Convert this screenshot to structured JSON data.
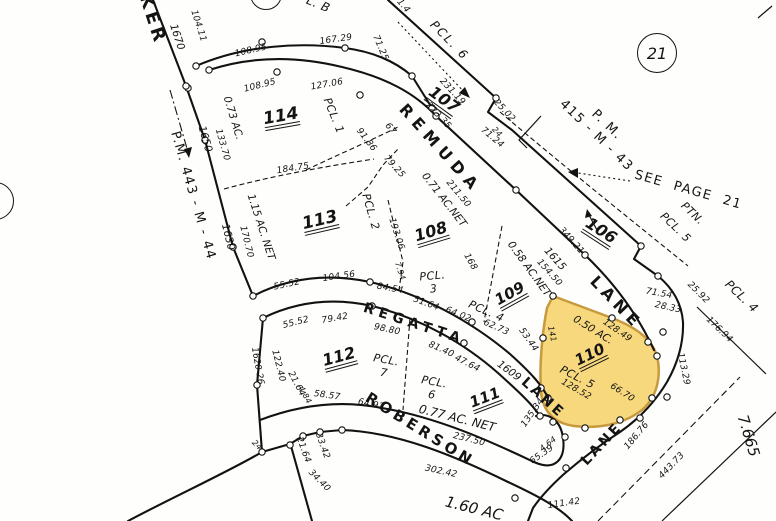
{
  "page_ref": {
    "circled": "21"
  },
  "highlight": {
    "parcel": "110",
    "fill": "#F7D87D",
    "edge": "#C79A3E"
  },
  "labels": [
    {
      "n": "street-walker-partial",
      "t": "KER",
      "x": 152,
      "y": 20,
      "r": 72,
      "c": "street",
      "s": 18,
      "sp": 4
    },
    {
      "n": "street-remuda",
      "t": "REMUDA",
      "x": 440,
      "y": 149,
      "r": 48,
      "c": "street",
      "s": 16,
      "sp": 6
    },
    {
      "n": "street-remuda-lane",
      "t": "LANE",
      "x": 616,
      "y": 303,
      "r": 46,
      "c": "street",
      "s": 16,
      "sp": 5
    },
    {
      "n": "street-regatta",
      "t": "REGATTA",
      "x": 414,
      "y": 324,
      "r": 18,
      "c": "street",
      "s": 14,
      "sp": 5
    },
    {
      "n": "street-regatta-lane",
      "t": "LANE",
      "x": 543,
      "y": 398,
      "r": 42,
      "c": "street",
      "s": 14,
      "sp": 3
    },
    {
      "n": "street-roberson",
      "t": "ROBERSON",
      "x": 420,
      "y": 430,
      "r": 32,
      "c": "street",
      "s": 15,
      "sp": 4
    },
    {
      "n": "street-roberson-lane",
      "t": "LANE",
      "x": 602,
      "y": 444,
      "r": -47,
      "c": "street",
      "s": 14,
      "sp": 3
    },
    {
      "n": "ref-pm-443-m-44",
      "t": "P.M. 443 - M - 44",
      "x": 192,
      "y": 196,
      "r": 74,
      "c": "ref"
    },
    {
      "n": "ref-pm-415-m-43",
      "t": "P. M.\n415 - M - 43",
      "x": 601,
      "y": 131,
      "r": 44,
      "c": "ref"
    },
    {
      "n": "ref-see-page-21",
      "t": "SEE  PAGE  21",
      "x": 688,
      "y": 191,
      "r": 16,
      "c": "ref"
    },
    {
      "n": "ref-ptn",
      "t": "PTN.",
      "x": 692,
      "y": 214,
      "r": 44,
      "c": "pcl"
    },
    {
      "n": "ref-ptn-pcl-5",
      "t": "PCL. 5",
      "x": 675,
      "y": 228,
      "r": 44,
      "c": "pcl"
    },
    {
      "n": "ref-pcl-6-north",
      "t": "PCL. 6",
      "x": 449,
      "y": 41,
      "r": 46,
      "c": "pcl",
      "s": 12,
      "sp": 2
    },
    {
      "n": "ref-pcl-4-east",
      "t": "PCL. 4",
      "x": 741,
      "y": 297,
      "r": 44,
      "c": "pcl",
      "s": 12
    },
    {
      "n": "ref-pcl-b-partial",
      "t": "L. B",
      "x": 318,
      "y": 5,
      "r": 22,
      "c": "pcl",
      "s": 12
    },
    {
      "n": "parcel-106",
      "t": "106",
      "x": 601,
      "y": 231,
      "r": 33,
      "c": "pnum"
    },
    {
      "n": "parcel-107",
      "t": "107",
      "x": 444,
      "y": 100,
      "r": 36,
      "c": "pnum"
    },
    {
      "n": "parcel-108",
      "t": "108",
      "x": 431,
      "y": 232,
      "r": -17,
      "c": "pnum"
    },
    {
      "n": "parcel-109",
      "t": "109",
      "x": 510,
      "y": 294,
      "r": -29,
      "c": "pnum",
      "s": 15
    },
    {
      "n": "parcel-110",
      "t": "110",
      "x": 590,
      "y": 355,
      "r": -26,
      "c": "pnum",
      "s": 15
    },
    {
      "n": "parcel-111",
      "t": "111",
      "x": 485,
      "y": 398,
      "r": -21,
      "c": "pnum",
      "s": 15
    },
    {
      "n": "parcel-112",
      "t": "112",
      "x": 339,
      "y": 357,
      "r": -15,
      "c": "pnum"
    },
    {
      "n": "parcel-113",
      "t": "113",
      "x": 320,
      "y": 221,
      "r": -13,
      "c": "pnum",
      "s": 17
    },
    {
      "n": "parcel-114",
      "t": "114",
      "x": 281,
      "y": 117,
      "r": -10,
      "c": "pnum",
      "s": 17
    },
    {
      "n": "pcl-1",
      "t": "PCL. 1",
      "x": 333,
      "y": 116,
      "r": 68,
      "c": "pcl"
    },
    {
      "n": "pcl-2",
      "t": "PCL. 2",
      "x": 370,
      "y": 212,
      "r": 74,
      "c": "pcl"
    },
    {
      "n": "pcl-3",
      "t": "PCL.\n3",
      "x": 433,
      "y": 283,
      "r": -5,
      "c": "pcl"
    },
    {
      "n": "pcl-4",
      "t": "PCL. 4",
      "x": 486,
      "y": 312,
      "r": 24,
      "c": "pcl"
    },
    {
      "n": "pcl-5",
      "t": "PCL. 5",
      "x": 577,
      "y": 378,
      "r": 27,
      "c": "pcl"
    },
    {
      "n": "pcl-6",
      "t": "PCL.\n6",
      "x": 433,
      "y": 389,
      "r": 10,
      "c": "pcl"
    },
    {
      "n": "pcl-7",
      "t": "PCL.\n7",
      "x": 385,
      "y": 367,
      "r": 10,
      "c": "pcl"
    },
    {
      "n": "acreage-114",
      "t": "0.73 AC.",
      "x": 233,
      "y": 118,
      "r": 73,
      "c": "ac"
    },
    {
      "n": "acreage-113",
      "t": "1.15 AC. NET",
      "x": 261,
      "y": 227,
      "r": 72,
      "c": "ac"
    },
    {
      "n": "acreage-108",
      "t": "0.71 AC.NET",
      "x": 444,
      "y": 200,
      "r": 52,
      "c": "ac"
    },
    {
      "n": "acreage-109",
      "t": "0.58 AC.NET",
      "x": 529,
      "y": 269,
      "r": 54,
      "c": "ac"
    },
    {
      "n": "acreage-110",
      "t": "0.50 AC.",
      "x": 593,
      "y": 330,
      "r": 32,
      "c": "ac"
    },
    {
      "n": "acreage-111",
      "t": "0.77 AC. NET",
      "x": 457,
      "y": 419,
      "r": 14,
      "c": "ac",
      "s": 12
    },
    {
      "n": "acreage-south",
      "t": "1.60 AC",
      "x": 474,
      "y": 509,
      "r": 14,
      "c": "ac",
      "s": 15
    },
    {
      "n": "acreage-east",
      "t": "7.665",
      "x": 748,
      "y": 436,
      "r": 73,
      "c": "ac",
      "s": 15
    },
    {
      "n": "addr-1670",
      "t": "1670",
      "x": 177,
      "y": 37,
      "r": 72,
      "c": "addr"
    },
    {
      "n": "addr-1650",
      "t": "1650",
      "x": 205,
      "y": 139,
      "r": 74,
      "c": "addr"
    },
    {
      "n": "addr-1630",
      "t": "1630",
      "x": 228,
      "y": 237,
      "r": 76,
      "c": "addr"
    },
    {
      "n": "addr-1615",
      "t": "1615",
      "x": 555,
      "y": 259,
      "r": 48,
      "c": "addr"
    },
    {
      "n": "addr-1609",
      "t": "1609",
      "x": 509,
      "y": 371,
      "r": 36,
      "c": "addr"
    },
    {
      "n": "addr-1620-26",
      "t": "1620-26",
      "x": 257,
      "y": 366,
      "r": 80,
      "c": "addr",
      "s": 9
    },
    {
      "t": "104.11",
      "x": 198,
      "y": 26,
      "r": 72,
      "c": "dim"
    },
    {
      "t": "108.95",
      "x": 251,
      "y": 51,
      "r": -13,
      "c": "dim"
    },
    {
      "t": "167.29",
      "x": 336,
      "y": 40,
      "r": -8,
      "c": "dim"
    },
    {
      "t": "108.95",
      "x": 260,
      "y": 86,
      "r": -14,
      "c": "dim"
    },
    {
      "t": "127.06",
      "x": 327,
      "y": 85,
      "r": -10,
      "c": "dim"
    },
    {
      "t": "71.25",
      "x": 380,
      "y": 48,
      "r": 67,
      "c": "dim"
    },
    {
      "t": "133.70",
      "x": 222,
      "y": 145,
      "r": 74,
      "c": "dim"
    },
    {
      "t": "170.70",
      "x": 246,
      "y": 242,
      "r": 76,
      "c": "dim"
    },
    {
      "t": "184.75",
      "x": 293,
      "y": 169,
      "r": -9,
      "c": "dim"
    },
    {
      "t": "231.19",
      "x": 452,
      "y": 92,
      "r": 47,
      "c": "dim"
    },
    {
      "t": "223.35",
      "x": 438,
      "y": 116,
      "r": 47,
      "c": "dim"
    },
    {
      "t": "25.02",
      "x": 504,
      "y": 111,
      "r": 47,
      "c": "dim"
    },
    {
      "t": "24",
      "x": 497,
      "y": 132,
      "r": 47,
      "c": "dim",
      "s": 8
    },
    {
      "t": "71.24",
      "x": 492,
      "y": 138,
      "r": 40,
      "c": "dim"
    },
    {
      "t": "211.50",
      "x": 458,
      "y": 194,
      "r": 50,
      "c": "dim"
    },
    {
      "t": "91.86",
      "x": 366,
      "y": 140,
      "r": 52,
      "c": "dim"
    },
    {
      "t": "67",
      "x": 390,
      "y": 129,
      "r": 52,
      "c": "dim"
    },
    {
      "t": "79.25",
      "x": 394,
      "y": 167,
      "r": 48,
      "c": "dim"
    },
    {
      "t": "193.06",
      "x": 396,
      "y": 234,
      "r": 72,
      "c": "dim"
    },
    {
      "t": "7.94",
      "x": 400,
      "y": 271,
      "r": 72,
      "c": "dim",
      "s": 8
    },
    {
      "t": "168",
      "x": 470,
      "y": 262,
      "r": 60,
      "c": "dim"
    },
    {
      "t": "349.21",
      "x": 571,
      "y": 241,
      "r": 48,
      "c": "dim"
    },
    {
      "t": "154.50",
      "x": 549,
      "y": 273,
      "r": 48,
      "c": "dim"
    },
    {
      "t": "55.52",
      "x": 287,
      "y": 285,
      "r": -12,
      "c": "dim"
    },
    {
      "t": "104.56",
      "x": 339,
      "y": 277,
      "r": -8,
      "c": "dim"
    },
    {
      "t": "55.52",
      "x": 296,
      "y": 323,
      "r": -14,
      "c": "dim"
    },
    {
      "t": "79.42",
      "x": 335,
      "y": 319,
      "r": -10,
      "c": "dim"
    },
    {
      "t": "98.80",
      "x": 387,
      "y": 330,
      "r": 12,
      "c": "dim"
    },
    {
      "t": "81.40",
      "x": 441,
      "y": 350,
      "r": 24,
      "c": "dim"
    },
    {
      "t": "47.64",
      "x": 467,
      "y": 364,
      "r": 27,
      "c": "dim"
    },
    {
      "t": "64.02",
      "x": 458,
      "y": 315,
      "r": 22,
      "c": "dim"
    },
    {
      "t": "62.73",
      "x": 496,
      "y": 328,
      "r": 24,
      "c": "dim"
    },
    {
      "t": "51.64",
      "x": 426,
      "y": 304,
      "r": 20,
      "c": "dim"
    },
    {
      "t": "84.54",
      "x": 390,
      "y": 289,
      "r": 10,
      "c": "dim"
    },
    {
      "t": "53.44",
      "x": 528,
      "y": 340,
      "r": 55,
      "c": "dim"
    },
    {
      "t": "128.49",
      "x": 617,
      "y": 331,
      "r": 35,
      "c": "dim"
    },
    {
      "t": "128.52",
      "x": 576,
      "y": 390,
      "r": 30,
      "c": "dim"
    },
    {
      "t": "66.70",
      "x": 622,
      "y": 393,
      "r": 33,
      "c": "dim"
    },
    {
      "t": "141",
      "x": 552,
      "y": 334,
      "r": 78,
      "c": "dim",
      "s": 8
    },
    {
      "t": "71.54",
      "x": 659,
      "y": 294,
      "r": 10,
      "c": "dim"
    },
    {
      "t": "28.33",
      "x": 668,
      "y": 308,
      "r": 12,
      "c": "dim"
    },
    {
      "t": "25.92",
      "x": 698,
      "y": 293,
      "r": 45,
      "c": "dim"
    },
    {
      "t": "176.94",
      "x": 719,
      "y": 330,
      "r": 44,
      "c": "dim"
    },
    {
      "t": "113.29",
      "x": 683,
      "y": 369,
      "r": 78,
      "c": "dim"
    },
    {
      "t": "443.73",
      "x": 672,
      "y": 466,
      "r": -46,
      "c": "dim"
    },
    {
      "t": "186.76",
      "x": 637,
      "y": 436,
      "r": -50,
      "c": "dim"
    },
    {
      "t": "111.42",
      "x": 564,
      "y": 504,
      "r": -8,
      "c": "dim"
    },
    {
      "t": "65.39",
      "x": 542,
      "y": 455,
      "r": -35,
      "c": "dim"
    },
    {
      "t": "4.64",
      "x": 548,
      "y": 444,
      "r": -38,
      "c": "dim",
      "s": 8
    },
    {
      "t": "135.34",
      "x": 533,
      "y": 413,
      "r": -55,
      "c": "dim"
    },
    {
      "t": "58.57",
      "x": 327,
      "y": 396,
      "r": 8,
      "c": "dim"
    },
    {
      "t": "64.92",
      "x": 371,
      "y": 405,
      "r": 12,
      "c": "dim"
    },
    {
      "t": "237.50",
      "x": 469,
      "y": 440,
      "r": 14,
      "c": "dim"
    },
    {
      "t": "302.42",
      "x": 441,
      "y": 472,
      "r": 12,
      "c": "dim"
    },
    {
      "t": "33.42",
      "x": 322,
      "y": 446,
      "r": 70,
      "c": "dim"
    },
    {
      "t": "21.64",
      "x": 303,
      "y": 450,
      "r": 70,
      "c": "dim"
    },
    {
      "t": "34.40",
      "x": 319,
      "y": 481,
      "r": 45,
      "c": "dim"
    },
    {
      "t": "24",
      "x": 257,
      "y": 445,
      "r": 45,
      "c": "dim",
      "s": 8
    },
    {
      "t": "21.64",
      "x": 296,
      "y": 384,
      "r": 62,
      "c": "dim"
    },
    {
      "t": "4.84",
      "x": 305,
      "y": 395,
      "r": 62,
      "c": "dim",
      "s": 8
    },
    {
      "t": "122.40",
      "x": 278,
      "y": 366,
      "r": 76,
      "c": "dim"
    },
    {
      "t": "31.4",
      "x": 401,
      "y": 4,
      "r": 50,
      "c": "dim"
    }
  ]
}
